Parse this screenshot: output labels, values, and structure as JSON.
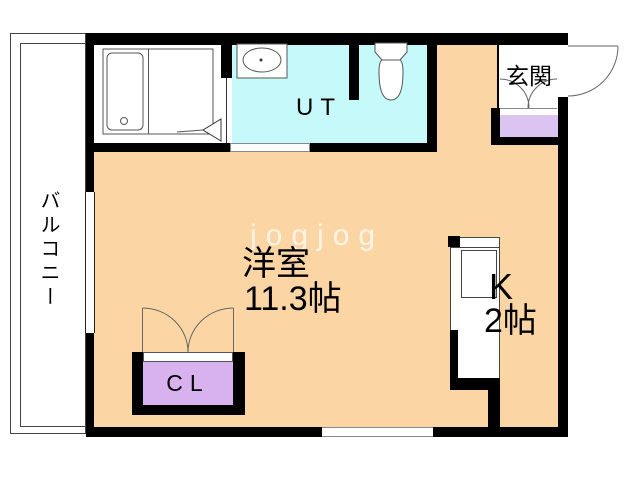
{
  "plan": {
    "watermark": "jogjog",
    "balcony_label": "バルコニー",
    "main_room_label": "洋室",
    "main_room_size": "11.3帖",
    "kitchen_label": "K",
    "kitchen_size": "2帖",
    "utility_label": "UT",
    "entrance_label": "玄関",
    "closet_label": "CL"
  },
  "colors": {
    "floor_main": "#fbd6a4",
    "floor_wet_area": "#c6fafa",
    "closet_fill": "#d7b2ef",
    "shoe_cabinet_fill": "#dcc4f2",
    "wall": "#000000",
    "fixture_outline": "#555555",
    "watermark": "rgba(255,255,255,0.72)"
  }
}
